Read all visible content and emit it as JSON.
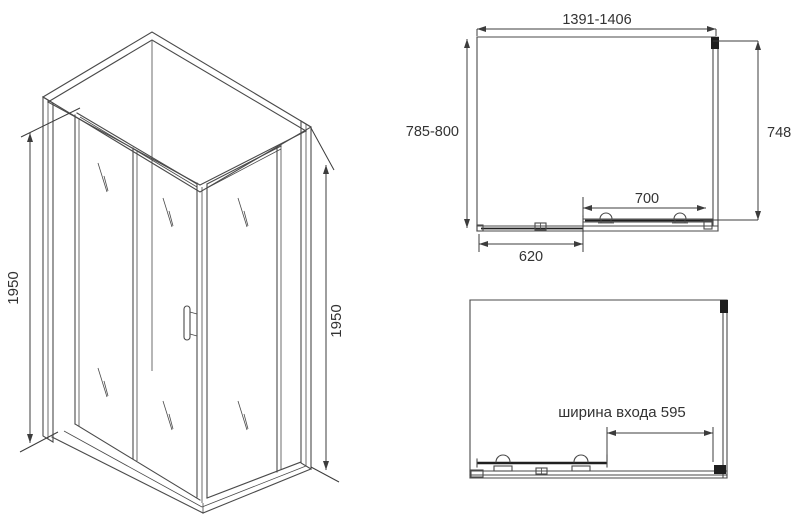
{
  "colors": {
    "line": "#4a4a4a",
    "dim": "#3c3c3c",
    "text": "#333333",
    "dark": "#1f1f1f",
    "bg": "#ffffff"
  },
  "iso_view": {
    "height_left": "1950",
    "height_right": "1950"
  },
  "plan_view": {
    "width_range": "1391-1406",
    "depth_range": "785-800",
    "side_panel": "748",
    "door_track": "700",
    "fixed_panel": "620"
  },
  "front_view": {
    "entrance_width": "ширина входа 595"
  }
}
